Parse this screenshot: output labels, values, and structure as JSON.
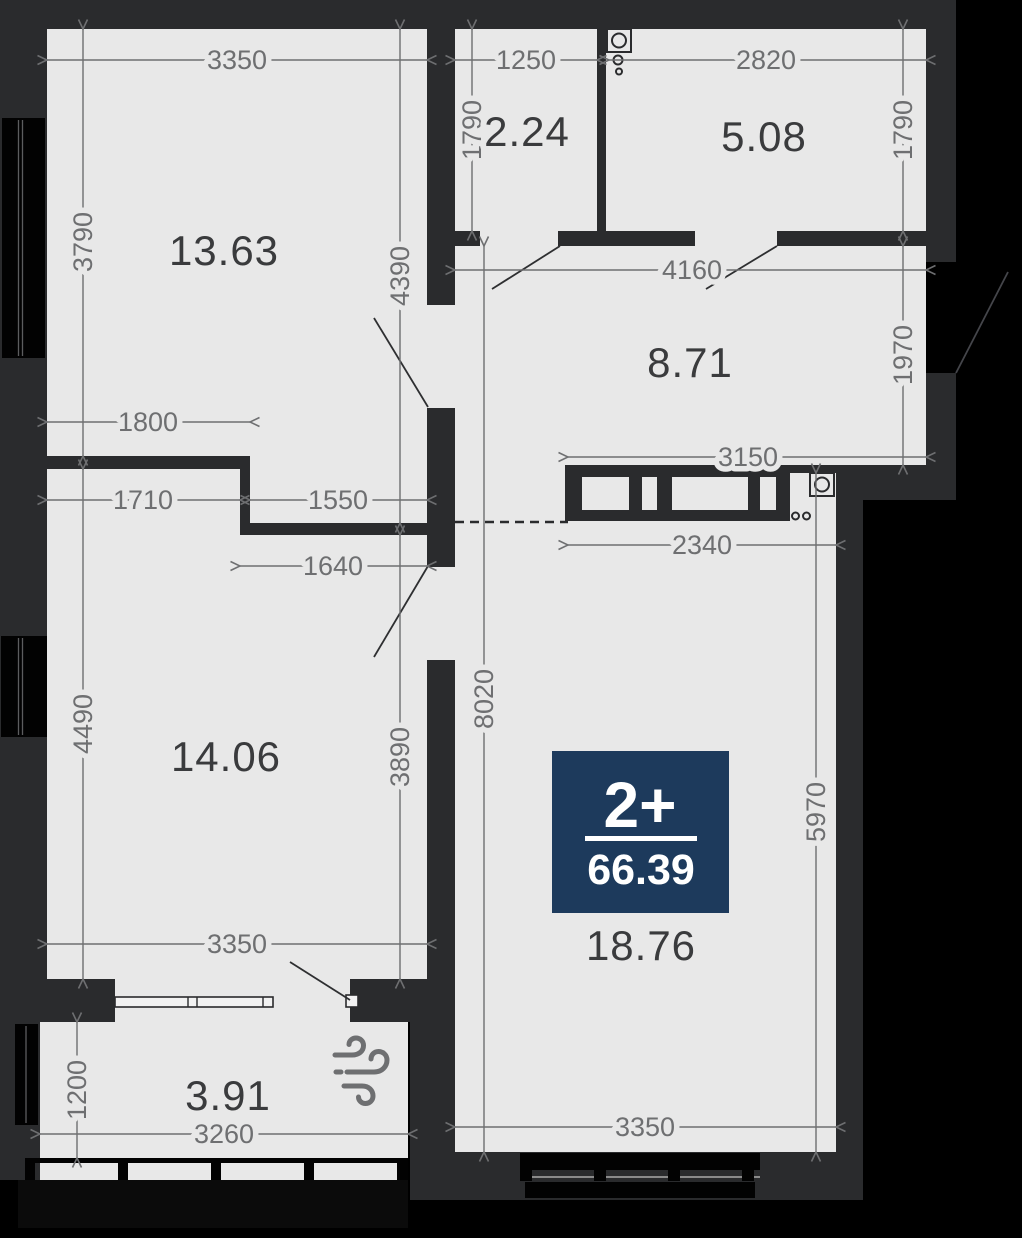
{
  "plan": {
    "badge": {
      "rooms_label": "2+",
      "total_area": "66.39",
      "bg_color": "#1d3a5c",
      "text_color": "#ffffff"
    },
    "rooms": {
      "room_13": "13.63",
      "room_2": "2.24",
      "room_5": "5.08",
      "room_8": "8.71",
      "room_14": "14.06",
      "room_18": "18.76",
      "balcony": "3.91"
    },
    "dims": {
      "d3350_top": "3350",
      "d1250": "1250",
      "d2820": "2820",
      "d1790_left": "1790",
      "d1790_right": "1790",
      "d3790": "3790",
      "d4390": "4390",
      "d4160": "4160",
      "d1970": "1970",
      "d1800": "1800",
      "d3150": "3150",
      "d1710": "1710",
      "d1550": "1550",
      "d1640": "1640",
      "d2340": "2340",
      "d4490": "4490",
      "d3890": "3890",
      "d8020": "8020",
      "d5970": "5970",
      "d3350_bottom_left": "3350",
      "d3350_bottom_right": "3350",
      "d1200": "1200",
      "d3260": "3260"
    },
    "colors": {
      "background": "#000000",
      "wall": "#2a2b2d",
      "floor": "#e8e8e8",
      "dim": "#6e6f71",
      "room_label": "#3a3b3d",
      "badge_bg": "#1d3a5c"
    },
    "icons": {
      "washer_top": "washing-machine-icon",
      "washer_side": "washing-machine-icon",
      "wind": "wind-icon"
    }
  }
}
